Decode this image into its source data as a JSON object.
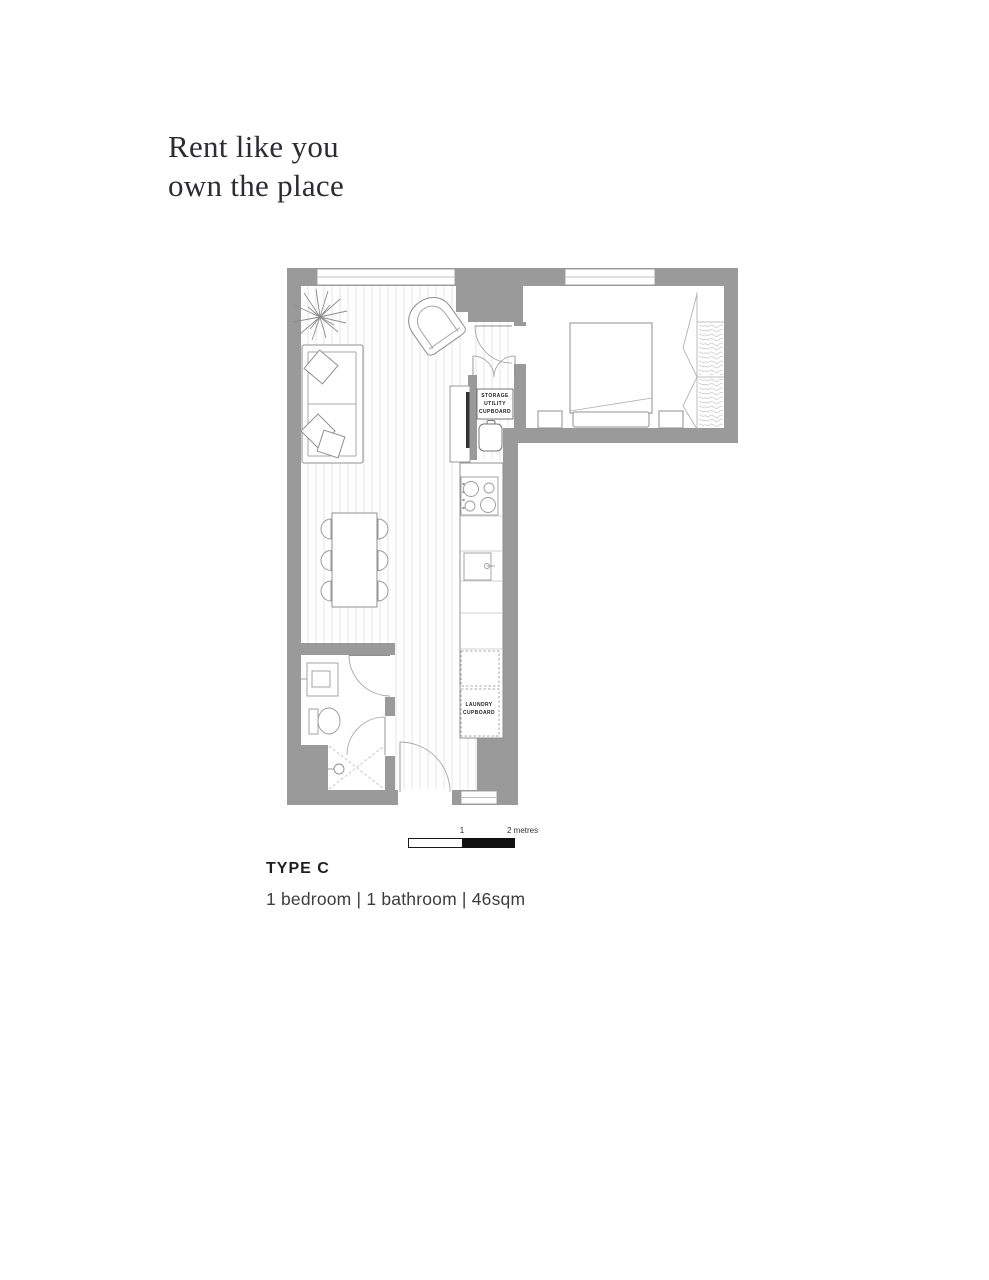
{
  "page": {
    "background": "#ffffff"
  },
  "heading": {
    "line1": "Rent like you",
    "line2": "own the place"
  },
  "plan": {
    "wall_color": "#9a9a9a",
    "floor_line_color": "#e6e6e6",
    "labels": {
      "storage": "STORAGE\nUTILITY\nCUPBOARD",
      "laundry": "LAUNDRY\nCUPBOARD"
    },
    "scale": {
      "mid_label": "1",
      "end_label": "2 metres"
    }
  },
  "caption": {
    "type": "TYPE C",
    "specs": "1 bedroom | 1 bathroom | 46sqm"
  }
}
